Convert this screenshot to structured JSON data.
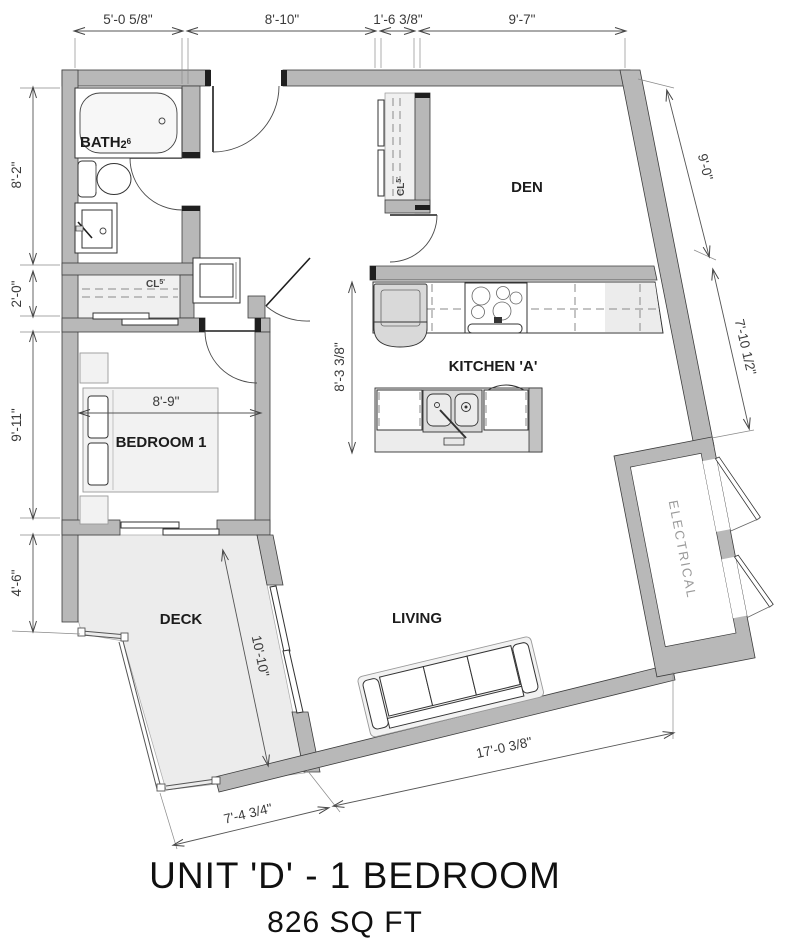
{
  "title": {
    "line1": "UNIT 'D' - 1 BEDROOM",
    "line2": "826 SQ FT"
  },
  "rooms": {
    "bath": {
      "label": "BATH",
      "tag": "2",
      "tag_sup": "6"
    },
    "den": "DEN",
    "kitchen": "KITCHEN 'A'",
    "bedroom": "BEDROOM 1",
    "deck": "DECK",
    "living": "LIVING",
    "electrical": "ELECTRICAL",
    "closet_entry": {
      "label": "CL",
      "sup": "5'"
    },
    "closet_bedroom": {
      "label": "CL",
      "sup": "5'"
    }
  },
  "dimensions": {
    "top": [
      "5'-0 5/8\"",
      "8'-10\"",
      "1'-6 3/8\"",
      "9'-7\""
    ],
    "left": [
      "8'-2\"",
      "2'-0\"",
      "9'-11\"",
      "4'-6\""
    ],
    "right": [
      "9'-0\"",
      "7'-10 1/2\""
    ],
    "interior": {
      "bedroom_width": "8'-9\"",
      "kitchen_depth": "8'-3 3/8\"",
      "deck_diagonal": "10'-10\"",
      "living_width": "17'-0 3/8\"",
      "deck_bottom": "7'-4 3/4\""
    }
  },
  "colors": {
    "wall": "#b8b8b8",
    "wall_outline": "#3d3d3d",
    "deck_fill": "#ececec",
    "fixture_gray": "#d9d9d9",
    "dim_text": "#3a3a3a",
    "electrical_text": "#9a9a9a",
    "background": "#ffffff"
  }
}
